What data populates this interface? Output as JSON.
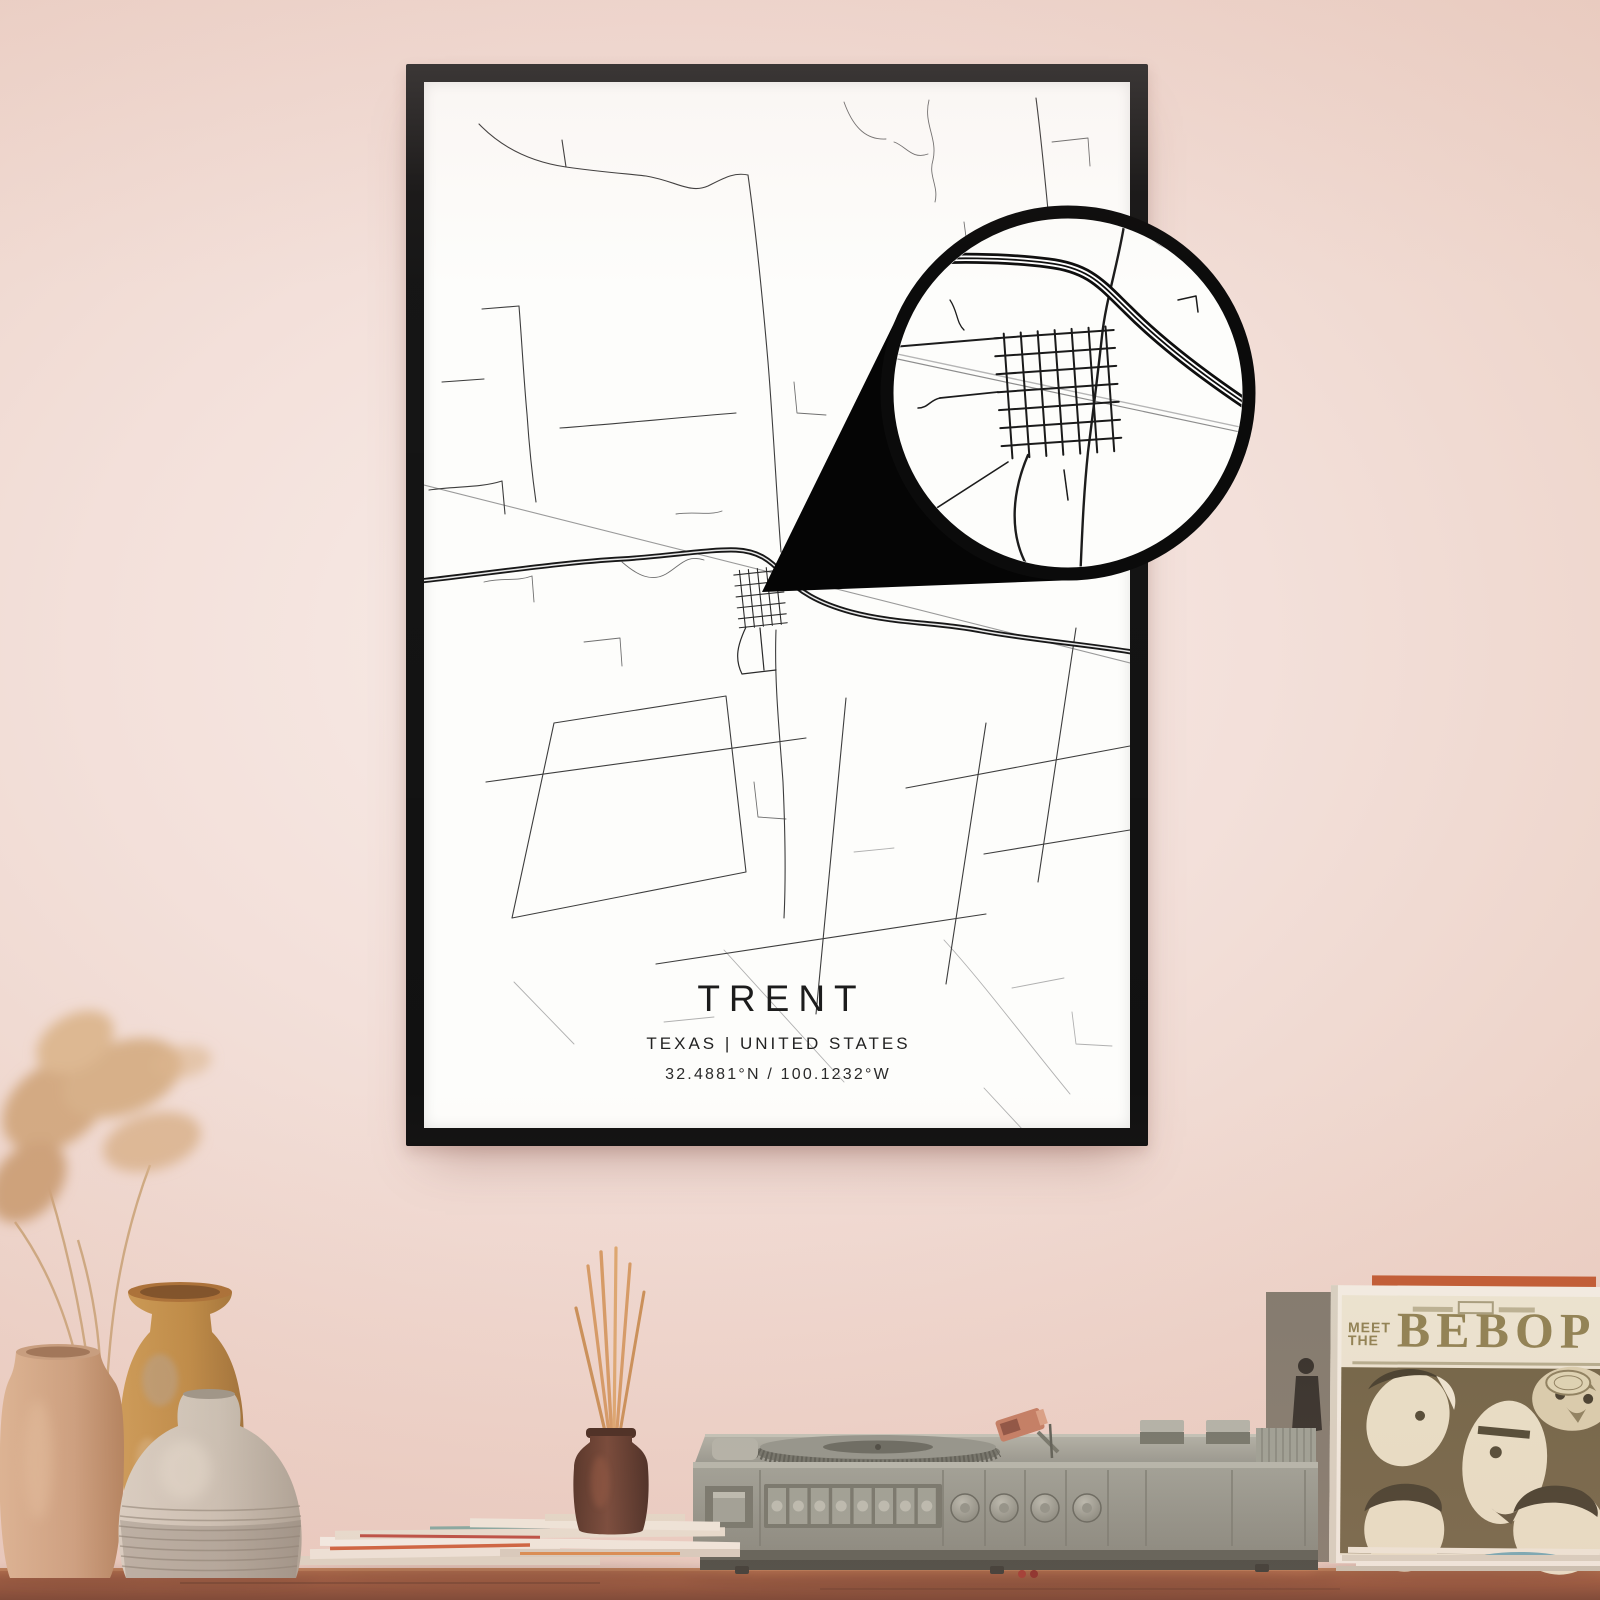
{
  "poster": {
    "title": "TRENT",
    "subtitle": "TEXAS | UNITED STATES",
    "coordinates": "32.4881°N / 100.1232°W"
  },
  "record_sleeve": {
    "line1": "MEET",
    "line2": "THE",
    "title": "BEBOP"
  },
  "colors": {
    "wall": "#eed6cc",
    "frame": "#161616",
    "poster_paper": "#fdfdfb",
    "map_road_dark": "#1a1a1a",
    "map_road_light": "#9a9a9a",
    "callout_black": "#050505",
    "table_wood": "#9a5a3c",
    "player_gray": "#949a8d",
    "sleeve_olive": "#6e6243",
    "sleeve_title_olive": "#8d8050",
    "vase_tan": "#c99b79",
    "vase_mustard": "#c08d45",
    "vase_white": "#cdc6b9",
    "pampas": "#d2a87e",
    "diffuser_brown": "#5d3727"
  }
}
